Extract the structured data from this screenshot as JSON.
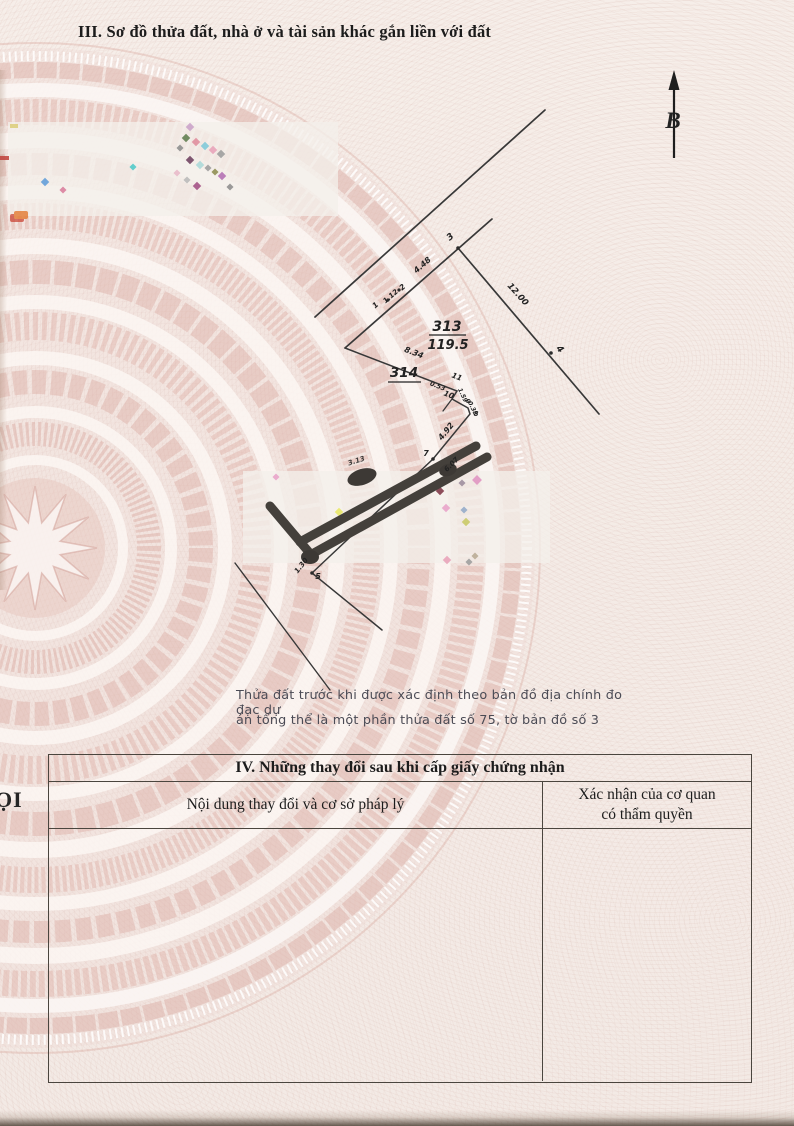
{
  "document": {
    "section3_title": "III. Sơ đồ thửa đất, nhà ở và tài sản khác gắn liền với đất",
    "compass_label": "B",
    "left_edge_text": "ỌI",
    "note_line1": "Thửa đất trước khi được xác định theo bản đồ địa chính đo đạc dự",
    "note_line2": "án tổng thể là một phần thửa đất số 75, tờ bản đồ số 3"
  },
  "diagram": {
    "parcel_313": {
      "number": "313",
      "area": "119.5"
    },
    "parcel_314": {
      "number": "314"
    },
    "points": {
      "p1": "1",
      "p2": "2",
      "p3": "3",
      "p4": "4",
      "p5": "5",
      "p7": "7",
      "p8": "8",
      "p9": "9",
      "p10": "10",
      "p11": "11"
    },
    "dims": {
      "edge_3_2": "4.48",
      "edge_2_1": "1.12",
      "edge_3_4": "12.00",
      "edge_boundary": "8.34",
      "notch_1": "0.53",
      "notch_2": "1.59",
      "notch_3": "0.38",
      "edge_8_7": "4.92",
      "edge_7_6": "6.07",
      "road_dim": "3.13",
      "edge_near_5": "1.30"
    }
  },
  "section4": {
    "title": "IV. Những thay đổi sau khi cấp giấy chứng nhận",
    "col1_header": "Nội dung thay đổi và cơ sở pháp lý",
    "col2_header_line1": "Xác nhận của cơ quan",
    "col2_header_line2": "có thẩm quyền"
  },
  "colors": {
    "paper": "#f4ebe6",
    "guilloche_pink": "#e3beb6",
    "diagram_line": "#383838",
    "redaction_dark": "#44403b",
    "note_text": "#4b4b55"
  }
}
